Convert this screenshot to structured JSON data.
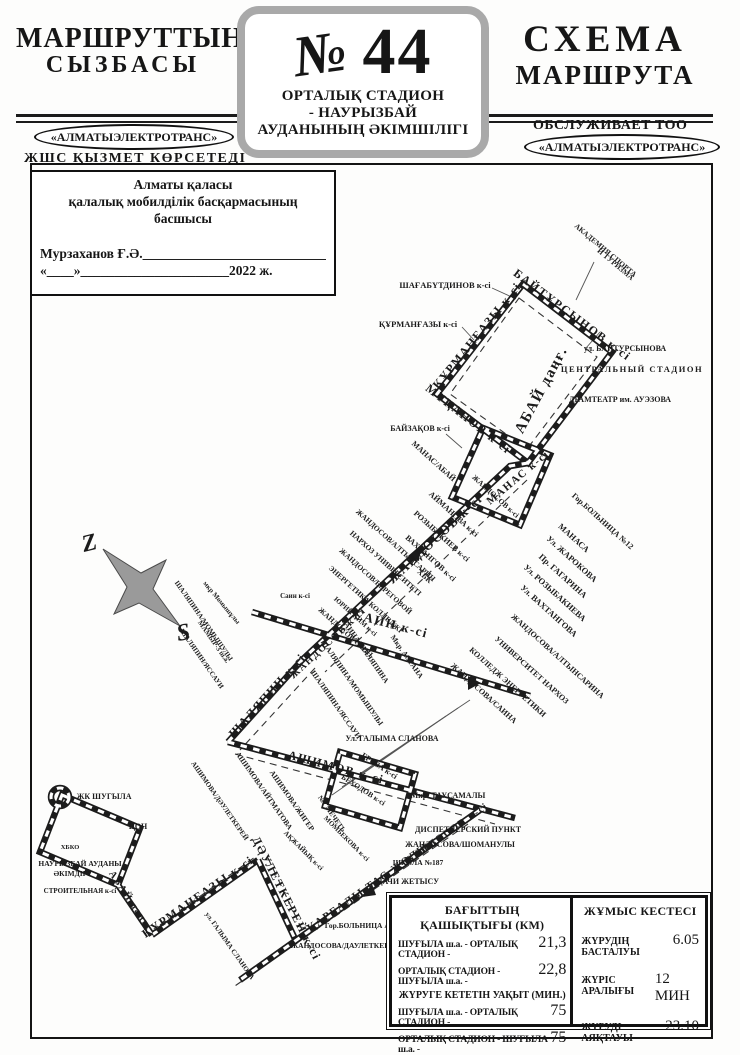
{
  "header": {
    "title_left_line1": "МАРШРУТТЫҢ",
    "title_left_line2": "СЫЗБАСЫ",
    "title_right_line1": "СХЕМА",
    "title_right_line2": "МАРШРУТА",
    "left_oval": "«АЛМАТЫЭЛЕКТРОТРАНС»",
    "left_sub": "ЖШС  ҚЫЗМЕТ КӨРСЕТЕДІ",
    "right_serves": "ОБСЛУЖИВАЕТ ТОО",
    "right_oval": "«АЛМАТЫЭЛЕКТРОТРАНС»"
  },
  "badge": {
    "no_sign": "№",
    "number": "44",
    "name_line1": "ОРТАЛЫҚ СТАДИОН",
    "name_line2": "- НАУРЫЗБАЙ",
    "name_line3": "АУДАНЫНЫҢ ӘКІМШІЛІГІ"
  },
  "approval": {
    "line1": "Алматы қаласы",
    "line2": "қалалық мобилділік басқармасының басшысы",
    "name_line": "Мурзаханов Ғ.Ә.____________________________",
    "date_line": "«____»______________________2022 ж."
  },
  "map": {
    "compass": {
      "north": "Z",
      "south": "S"
    },
    "labels": [
      {
        "t": "ШАҒАБҮТДИНОВ к-сі",
        "x": 445,
        "y": 288,
        "r": 0,
        "s": 8.5
      },
      {
        "t": "ҚҰРМАНҒАЗЫ к-сі",
        "x": 418,
        "y": 327,
        "r": 0,
        "s": 8.5
      },
      {
        "t": "ҚҰРМАНҒАЗЫ к-сі",
        "x": 480,
        "y": 338,
        "r": -51,
        "s": 12,
        "b": 1
      },
      {
        "t": "БАЙТҰРСЫНОВ к-сі",
        "x": 570,
        "y": 318,
        "r": 37,
        "s": 12,
        "b": 1
      },
      {
        "t": "АКАДЕМИЯ СПОРТА",
        "x": 604,
        "y": 252,
        "r": 40,
        "s": 7.5
      },
      {
        "t": "И ТУРИЗМА",
        "x": 614,
        "y": 266,
        "r": 40,
        "s": 7.5
      },
      {
        "t": "ул. БАЙТУРСЫНОВА",
        "x": 625,
        "y": 351,
        "r": 0,
        "s": 8
      },
      {
        "t": "ЦЕНТРАЛЬНЫЙ СТАДИОН",
        "x": 632,
        "y": 372,
        "r": 0,
        "s": 8.5,
        "b": 1
      },
      {
        "t": "ДРАМТЕАТР им. АУЭЗОВА",
        "x": 620,
        "y": 402,
        "r": 0,
        "s": 8
      },
      {
        "t": "МҰҚАНОВ к-сі",
        "x": 466,
        "y": 422,
        "r": 38,
        "s": 12,
        "b": 1
      },
      {
        "t": "АБАЙ даңғ.",
        "x": 545,
        "y": 392,
        "r": -62,
        "s": 15,
        "b": 1
      },
      {
        "t": "БАЙЗАҚОВ к-сі",
        "x": 420,
        "y": 431,
        "r": 0,
        "s": 8
      },
      {
        "t": "МАНАС/АБАЙ",
        "x": 432,
        "y": 463,
        "r": 42,
        "s": 8
      },
      {
        "t": "МАНАС к-сі",
        "x": 520,
        "y": 480,
        "r": -40,
        "s": 11,
        "b": 1
      },
      {
        "t": "ЖАНДОСОВ к-сі",
        "x": 494,
        "y": 498,
        "r": 42,
        "s": 7.5
      },
      {
        "t": "Гор.БОЛЬНИЦА №12",
        "x": 601,
        "y": 523,
        "r": 42,
        "s": 8
      },
      {
        "t": "ЖАНДОСОВ к-сі",
        "x": 438,
        "y": 542,
        "r": -43,
        "s": 13,
        "b": 1
      },
      {
        "t": "ЖАНДОСОВ к-сі",
        "x": 330,
        "y": 645,
        "r": -43,
        "s": 10,
        "b": 1
      },
      {
        "t": "АЙМАНОВА к-сі",
        "x": 452,
        "y": 516,
        "r": 42,
        "s": 8
      },
      {
        "t": "РОЗЫБАКИЕВ к-сі",
        "x": 440,
        "y": 538,
        "r": 42,
        "s": 8
      },
      {
        "t": "ВАХТАНГОВ к-сі",
        "x": 429,
        "y": 560,
        "r": 42,
        "s": 8
      },
      {
        "t": "ХБК",
        "x": 423,
        "y": 578,
        "r": 42,
        "s": 8
      },
      {
        "t": "ЖАНДОСОВ/АЛТЫНСАРИН",
        "x": 394,
        "y": 547,
        "r": 42,
        "s": 7.5
      },
      {
        "t": "НАРХОЗ УНИВЕРСИТЕТІ",
        "x": 384,
        "y": 565,
        "r": 42,
        "s": 7.5
      },
      {
        "t": "ЖАНДОСОВ/БЕРЕГОВОЙ",
        "x": 374,
        "y": 583,
        "r": 42,
        "s": 7.5
      },
      {
        "t": "ЭНЕРГЕТИКА КОЛЛЕДЖІ",
        "x": 364,
        "y": 601,
        "r": 42,
        "s": 7.5
      },
      {
        "t": "ЮРИЙ КИМ к-сі",
        "x": 354,
        "y": 618,
        "r": 42,
        "s": 7
      },
      {
        "t": "ЖАНДОСОВ/САИН",
        "x": 344,
        "y": 634,
        "r": 42,
        "s": 7.5
      },
      {
        "t": "МАНАСА",
        "x": 572,
        "y": 540,
        "r": 42,
        "s": 8.5
      },
      {
        "t": "Ул. ЖАРОКОВА",
        "x": 570,
        "y": 561,
        "r": 42,
        "s": 8.5
      },
      {
        "t": "Пр. ГАГАРИНА",
        "x": 561,
        "y": 578,
        "r": 42,
        "s": 8.5
      },
      {
        "t": "Ул. РОЗЫБАКИЕВА",
        "x": 553,
        "y": 595,
        "r": 42,
        "s": 8.5
      },
      {
        "t": "Ул. ВАХТАНГОВА",
        "x": 547,
        "y": 613,
        "r": 42,
        "s": 8.5
      },
      {
        "t": "ЖАНДОСОВА/АЛТЫНСАРИНА",
        "x": 556,
        "y": 658,
        "r": 42,
        "s": 8
      },
      {
        "t": "УНИВЕРСИТЕТ НАРХОЗ",
        "x": 530,
        "y": 672,
        "r": 42,
        "s": 8
      },
      {
        "t": "КОЛЛЕДЖ ЭНЕРГЕТИКИ",
        "x": 506,
        "y": 684,
        "r": 42,
        "s": 8
      },
      {
        "t": "ЖАНДОСОВА/САИНА",
        "x": 482,
        "y": 695,
        "r": 42,
        "s": 8
      },
      {
        "t": "САИН к-сі",
        "x": 390,
        "y": 628,
        "r": 15,
        "s": 13,
        "b": 1
      },
      {
        "t": "Саин к-сі",
        "x": 295,
        "y": 598,
        "r": 0,
        "s": 7
      },
      {
        "t": "мкр Момышұлы",
        "x": 220,
        "y": 604,
        "r": 50,
        "s": 7
      },
      {
        "t": "САИНА/ШАЛЯПИНА",
        "x": 363,
        "y": 652,
        "r": 55,
        "s": 7.5
      },
      {
        "t": "Мкр. АСТАНА",
        "x": 405,
        "y": 658,
        "r": 55,
        "s": 7.5
      },
      {
        "t": "ШАЛЯПИНА/МОМЫШУЛЫ",
        "x": 350,
        "y": 684,
        "r": 55,
        "s": 7.5
      },
      {
        "t": "ШАЛЯПИНА/ЯССАУИ",
        "x": 334,
        "y": 706,
        "r": 55,
        "s": 7.5
      },
      {
        "t": "ШАЛЯПИНА/МОМЫШУЛЫ",
        "x": 202,
        "y": 622,
        "r": 55,
        "s": 7
      },
      {
        "t": "МАМЫР-3 ш.а.",
        "x": 212,
        "y": 643,
        "r": 55,
        "s": 7
      },
      {
        "t": "ШАЛЯПИН/ЯССАУИ",
        "x": 200,
        "y": 660,
        "r": 55,
        "s": 7
      },
      {
        "t": "ШАЛЯПИН к-сі",
        "x": 270,
        "y": 698,
        "r": -48,
        "s": 12,
        "b": 1
      },
      {
        "t": "Ул. ГАЛЫМА СЛАНОВА",
        "x": 392,
        "y": 741,
        "r": 0,
        "s": 8
      },
      {
        "t": "АШИМОВ к-сі",
        "x": 335,
        "y": 771,
        "r": 15,
        "s": 12,
        "b": 1
      },
      {
        "t": "АШИМОВА/АЙТМАТОВА",
        "x": 262,
        "y": 792,
        "r": 55,
        "s": 7.5
      },
      {
        "t": "АШИМОВА/ЖИГЕР",
        "x": 290,
        "y": 802,
        "r": 55,
        "s": 7.5
      },
      {
        "t": "АШИМОВА/ДӘУЛЕТКЕРЕЙ",
        "x": 218,
        "y": 802,
        "r": 55,
        "s": 7
      },
      {
        "t": "ГРОЗА к-сі",
        "x": 378,
        "y": 768,
        "r": 33,
        "s": 8
      },
      {
        "t": "БЕХОДОВ к-сі",
        "x": 362,
        "y": 792,
        "r": 33,
        "s": 7.5
      },
      {
        "t": "№7 МЕЧЕТЬ",
        "x": 330,
        "y": 815,
        "r": 55,
        "s": 7
      },
      {
        "t": "МОМБЕКОВА к-сі",
        "x": 345,
        "y": 840,
        "r": 45,
        "s": 7
      },
      {
        "t": "АҚЖАЙЫҚ к-сі",
        "x": 302,
        "y": 852,
        "r": 45,
        "s": 7
      },
      {
        "t": "Мкр. ТАУСАМАЛЫ",
        "x": 448,
        "y": 798,
        "r": 0,
        "s": 8
      },
      {
        "t": "ДИСПЕТЧЕРСКИЙ ПУНКТ",
        "x": 468,
        "y": 832,
        "r": 0,
        "s": 8
      },
      {
        "t": "ЖАНДОСОВА/ШОМАНУЛЫ",
        "x": 460,
        "y": 847,
        "r": 0,
        "s": 8
      },
      {
        "t": "ШКОЛА №187",
        "x": 418,
        "y": 865,
        "r": 0,
        "s": 7.5
      },
      {
        "t": "ДАЧИ ЖЕТЫСУ",
        "x": 408,
        "y": 884,
        "r": 0,
        "s": 8
      },
      {
        "t": "ЖАНДОСОВ к-сі",
        "x": 448,
        "y": 836,
        "r": -35,
        "s": 10,
        "b": 1
      },
      {
        "t": "ҚАРҒАЛЫ ТАС ЖОЛЫ",
        "x": 370,
        "y": 890,
        "r": -35,
        "s": 11,
        "b": 1
      },
      {
        "t": "Гор.БОЛЬНИЦА АКСАЙ",
        "x": 368,
        "y": 928,
        "r": 0,
        "s": 7.5
      },
      {
        "t": "ЖАНДОСОВА/ДАУЛЕТКЕРЕЯ",
        "x": 345,
        "y": 948,
        "r": 0,
        "s": 7.5
      },
      {
        "t": "ЖК ШУГЫЛА",
        "x": 104,
        "y": 799,
        "r": 0,
        "s": 8
      },
      {
        "t": "ЦОН",
        "x": 138,
        "y": 829,
        "r": 0,
        "s": 8
      },
      {
        "t": "ХБКО",
        "x": 70,
        "y": 849,
        "r": 0,
        "s": 6.5
      },
      {
        "t": "НАУРЫЗБАЙ АУДАНЫ",
        "x": 80,
        "y": 866,
        "r": 0,
        "s": 7.5
      },
      {
        "t": "ӘКІМДІГІ",
        "x": 72,
        "y": 876,
        "r": 0,
        "s": 7.5
      },
      {
        "t": "СТРОИТЕЛЬНАЯ к-сі",
        "x": 80,
        "y": 893,
        "r": 0,
        "s": 7
      },
      {
        "t": "АБАЙ даңғ.",
        "x": 128,
        "y": 902,
        "r": 56,
        "s": 10,
        "b": 1
      },
      {
        "t": "ҚҰРМАНҒАЗЫ к-сі",
        "x": 200,
        "y": 900,
        "r": -35,
        "s": 12,
        "b": 1
      },
      {
        "t": "ДӘУЛЕТКЕРЕЙ к-сі",
        "x": 283,
        "y": 900,
        "r": 63,
        "s": 12,
        "b": 1
      },
      {
        "t": "ул. ГАЛЫМА СЛАНОВА",
        "x": 228,
        "y": 947,
        "r": 55,
        "s": 7
      }
    ]
  },
  "tables": {
    "distance": {
      "title": "БАҒЫТТЫҢ ҚАШЫҚТЫҒЫ (КМ)",
      "rows": [
        {
          "label": "ШУҒЫЛА ш.а. - ОРТАЛЫҚ СТАДИОН -",
          "value": "21,3"
        },
        {
          "label": "ОРТАЛЫҚ СТАДИОН - ШУҒЫЛА ш.а. -",
          "value": "22,8"
        }
      ],
      "subtitle": "ЖҮРУГЕ КЕТЕТІН УАҚЫТ (МИН.)",
      "rows2": [
        {
          "label": "ШУҒЫЛА ш.а. - ОРТАЛЫҚ СТАДИОН -",
          "value": "75"
        },
        {
          "label": "ОРТАЛЫҚ СТАДИОН - ШУҒЫЛА ш.а. -",
          "value": "75"
        }
      ]
    },
    "schedule": {
      "title": "ЖҰМЫС КЕСТЕСІ",
      "rows": [
        {
          "label": "ЖҮРУДІҢ БАСТАЛУЫ",
          "value": "6.05"
        },
        {
          "label": "ЖҮРІС АРАЛЫҒЫ",
          "value": "12 МИН"
        },
        {
          "label": "ЖҮРУДІ АЯҚТАУЫ",
          "value": "23.10"
        }
      ]
    }
  }
}
